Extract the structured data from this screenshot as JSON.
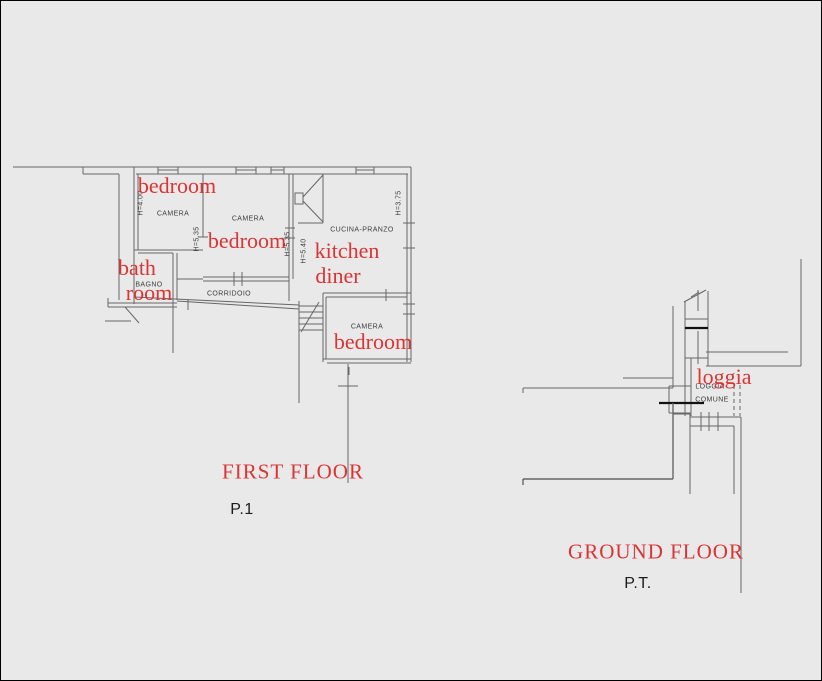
{
  "colors": {
    "background": "#e9e9e9",
    "line_gray": "#666666",
    "line_black": "#111111",
    "annotation_red": "#dc3434",
    "cad_text": "#3d3d3d"
  },
  "first_floor": {
    "title": "FIRST FLOOR",
    "code": "P.1",
    "cad_labels": {
      "camera1": "CAMERA",
      "camera2": "CAMERA",
      "camera3": "CAMERA",
      "cucina": "CUCINA-PRANZO",
      "bagno": "BAGNO",
      "corridoio": "CORRIDOIO"
    },
    "height_labels": {
      "h1": "H=4.00",
      "h2": "H=5.35",
      "h3": "H=5.35",
      "h4": "H=5.40",
      "h5": "H=3.75"
    },
    "annotations": {
      "bedroom1": "bedroom",
      "bedroom2": "bedroom",
      "bath_line1": "bath",
      "bath_line2": "room",
      "kitchen_line1": "kitchen",
      "kitchen_line2": "diner",
      "bedroom3": "bedroom"
    }
  },
  "ground_floor": {
    "title": "GROUND FLOOR",
    "code": "P.T.",
    "cad_labels": {
      "loggia_line1": "LOGGIA",
      "loggia_line2": "COMUNE"
    },
    "annotations": {
      "loggia": "loggia"
    }
  }
}
